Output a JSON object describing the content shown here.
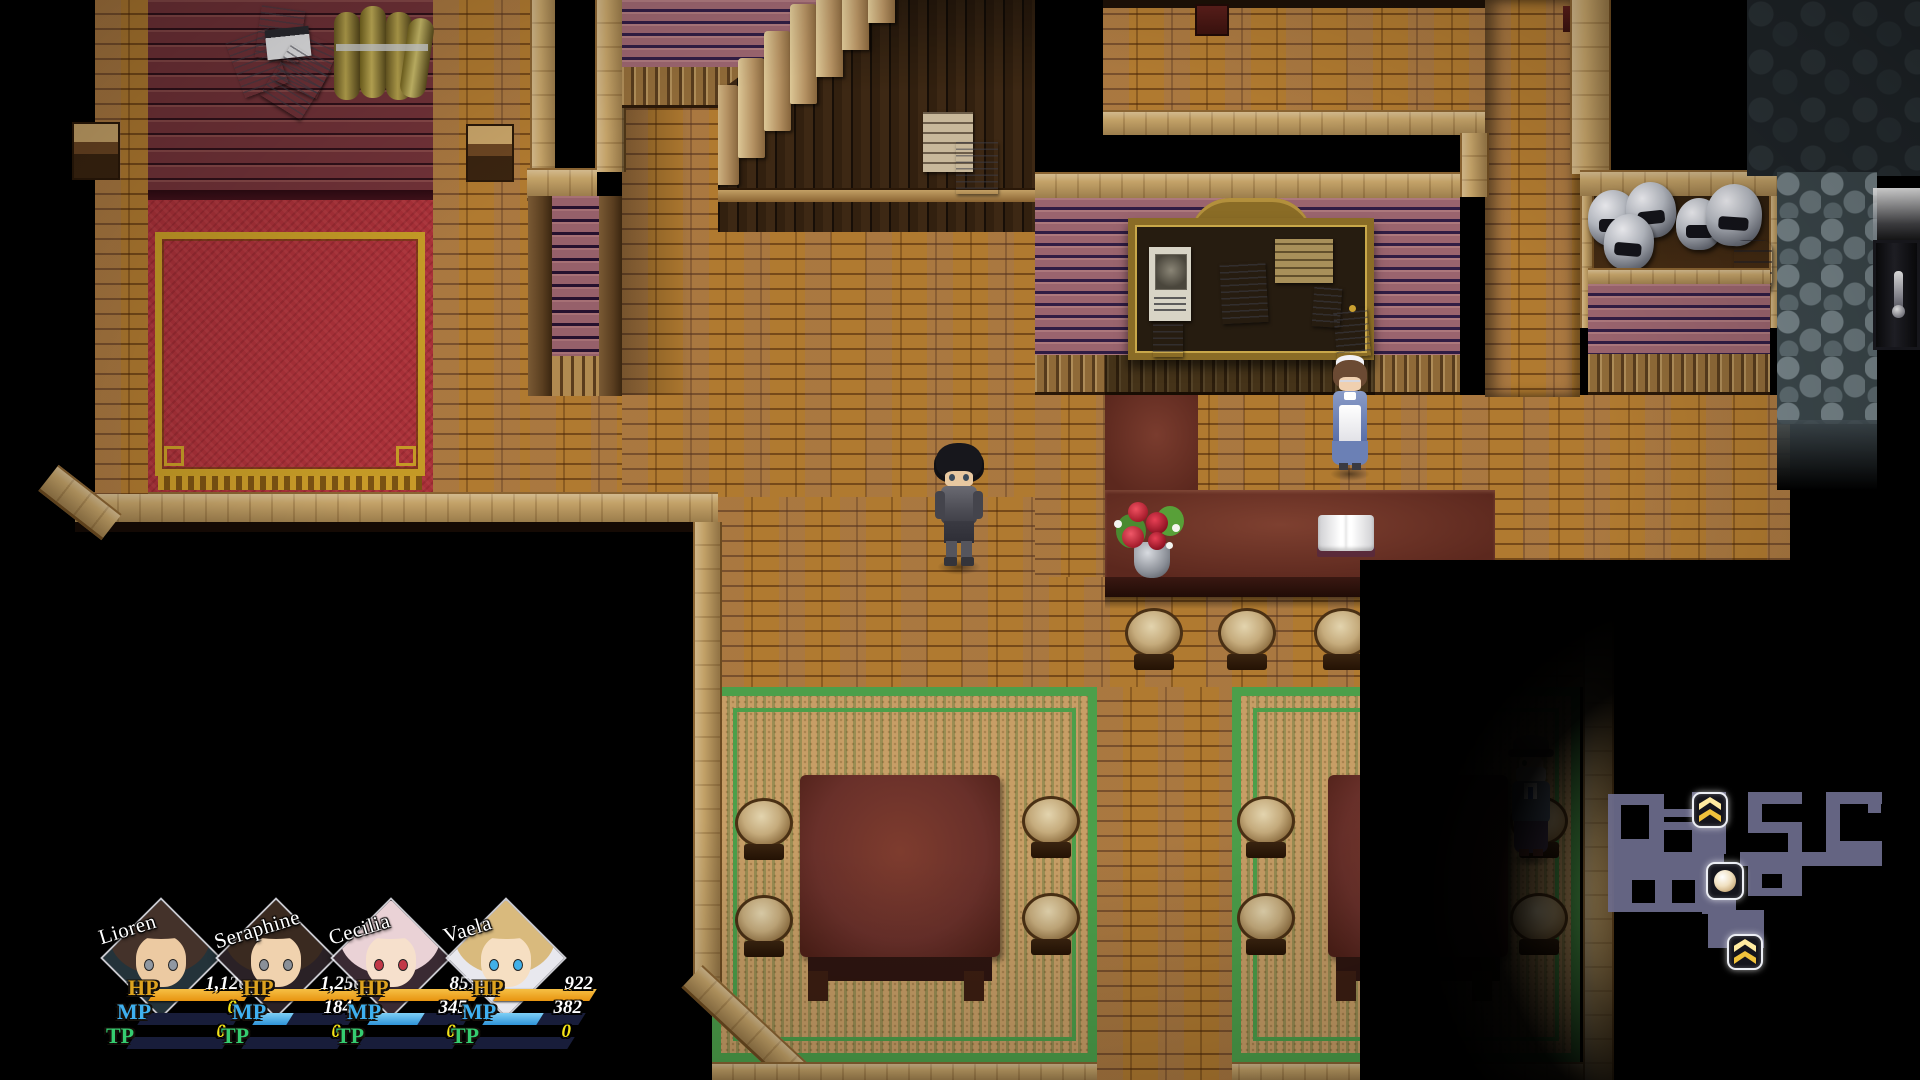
{
  "hud": {
    "bar_labels": {
      "hp": "HP",
      "mp": "MP",
      "tp": "TP"
    },
    "colors": {
      "hp_bar": "#e89410",
      "hp_bar_light": "#f6c045",
      "mp_bar": "#2f93d8",
      "mp_bar_light": "#7ed0f6",
      "tp_bar": "#2da868",
      "bar_bg": "#181d3a",
      "hp_label": "#dda31f",
      "mp_label": "#3fb0ef",
      "tp_label": "#35cc70",
      "zero_value": "#f5e516",
      "value": "#ffffff"
    },
    "party": [
      {
        "name": "Lioren",
        "hp": "1,126",
        "mp": "0",
        "tp": "0",
        "hp_pct": 100,
        "mp_pct": 0,
        "tp_pct": 0,
        "hp_color": "#ffffff",
        "mp_color": "#f5e516",
        "tp_color": "#f5e516",
        "hair": "#44322a",
        "skin": "#eccaa2",
        "eye": "#9098a2",
        "accent": "#24333a"
      },
      {
        "name": "Seraphine",
        "hp": "1,250",
        "mp": "184",
        "tp": "0",
        "hp_pct": 100,
        "mp_pct": 35,
        "tp_pct": 0,
        "hp_color": "#ffffff",
        "mp_color": "#ffffff",
        "tp_color": "#f5e516",
        "hair": "#3a2a20",
        "skin": "#f0d2ae",
        "eye": "#8a9098",
        "accent": "#2a2126"
      },
      {
        "name": "Cecilia",
        "hp": "851",
        "mp": "345",
        "tp": "0",
        "hp_pct": 100,
        "mp_pct": 52,
        "tp_pct": 0,
        "hp_color": "#ffffff",
        "mp_color": "#ffffff",
        "tp_color": "#f5e516",
        "hair": "#ead2d6",
        "skin": "#f6e0cc",
        "eye": "#c23848",
        "accent": "#3a2a33"
      },
      {
        "name": "Vaela",
        "hp": "922",
        "mp": "382",
        "tp": "0",
        "hp_pct": 100,
        "mp_pct": 56,
        "tp_pct": 0,
        "hp_color": "#ffffff",
        "mp_color": "#ffffff",
        "tp_color": "#f5e516",
        "hair": "#d9ba7d",
        "skin": "#f6dfc2",
        "eye": "#41b0e8",
        "accent": "#e8e8ee"
      }
    ]
  },
  "minimap": {
    "floor_color": "#6c6c8c",
    "icon_bg": "#14141c",
    "icon_border": "#eceef4",
    "chevron_gold": "#f0c23c",
    "chevron_gold_light": "#ffeaa0",
    "icons": [
      {
        "name": "stairs-up-icon"
      },
      {
        "name": "player-marker-icon"
      },
      {
        "name": "stairs-up-icon"
      }
    ]
  },
  "scene": {
    "palette": {
      "floor_brick": "#b07a30",
      "floor_sand": "#c79e66",
      "wall_maroon": "#713238",
      "wall_pink": "#9a646e",
      "carpet_red": "#a83038",
      "carpet_gold": "#c49a26",
      "green_border": "#4c9f4a",
      "counter_top": "#5c281e",
      "wood_trim": "#c3a268",
      "dark_plank": "#32200f",
      "cobblestone": "#3c484c",
      "vignette": "#000000"
    }
  }
}
